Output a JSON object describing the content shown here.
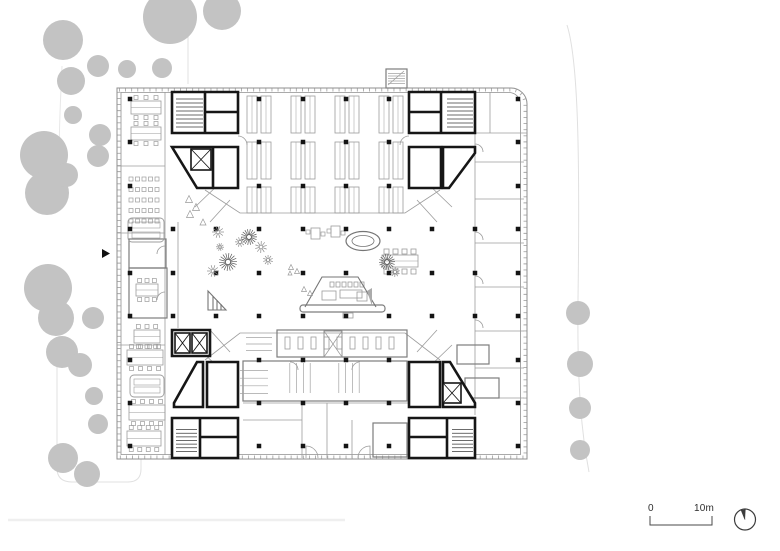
{
  "scale_bar": {
    "zero": "0",
    "ten": "10m"
  },
  "colors": {
    "tree": "#c3c3c3",
    "heavy": "#161616",
    "light": "#9c9c9c",
    "mid": "#757575",
    "facade": "#8f8f8f",
    "tick": "#a8a8a8",
    "column": "#141414",
    "site": "#e0e0e0",
    "stair": "#3a3a3a",
    "wedge": "#ababab",
    "marker": "#111111",
    "north": "#3c3c3c"
  },
  "geometry": {
    "site_paths": [
      {
        "d": "M567,25 C578,60 580,150 578,300 C577,390 582,435 589,472",
        "w": 1,
        "c": "#e0e0e0"
      },
      {
        "d": "M57,340 V468 Q57,482 72,482 H128 Q141,482 141,469 V450",
        "w": 1,
        "c": "#e0e0e0"
      },
      {
        "d": "M188,24 V84",
        "w": 1,
        "c": "#e0e0e0"
      },
      {
        "d": "M62,66 C60,110 58,150 60,195",
        "w": 1,
        "c": "#e8e8e8"
      },
      {
        "d": "M8,520 H345",
        "w": 2.5,
        "c": "#efefef"
      }
    ],
    "trees": [
      [
        63,
        40,
        20
      ],
      [
        170,
        17,
        27
      ],
      [
        222,
        11,
        19
      ],
      [
        98,
        66,
        11
      ],
      [
        127,
        69,
        9
      ],
      [
        162,
        68,
        10
      ],
      [
        71,
        81,
        14
      ],
      [
        73,
        115,
        9
      ],
      [
        44,
        155,
        24
      ],
      [
        47,
        193,
        22
      ],
      [
        66,
        175,
        12
      ],
      [
        100,
        135,
        11
      ],
      [
        98,
        156,
        11
      ],
      [
        48,
        288,
        24
      ],
      [
        56,
        318,
        18
      ],
      [
        93,
        318,
        11
      ],
      [
        62,
        352,
        16
      ],
      [
        80,
        365,
        12
      ],
      [
        94,
        396,
        9
      ],
      [
        98,
        424,
        10
      ],
      [
        63,
        458,
        15
      ],
      [
        87,
        474,
        13
      ],
      [
        578,
        313,
        12
      ],
      [
        580,
        364,
        13
      ],
      [
        580,
        408,
        11
      ],
      [
        580,
        450,
        10
      ]
    ],
    "building": {
      "outer": "M117,88 H511 A16,16 0 0 1 527,104 V459 H117 Z",
      "ticks": "M119,90 H510 A14,14 0 0 1 525,104 V457 H119 Z",
      "inner": "M121,92.5 H509 A11.5,11.5 0 0 1 520.5,104 V454.5 H121 Z"
    },
    "light_paths": [
      {
        "d": "M165,92 V455"
      },
      {
        "d": "M475,133 V415"
      },
      {
        "d": "M475,133 H527"
      },
      {
        "d": "M475,162 H524"
      },
      {
        "d": "M475,199 H524"
      },
      {
        "d": "M475,243 H524"
      },
      {
        "d": "M475,287 H524"
      },
      {
        "d": "M475,331 H524"
      },
      {
        "d": "M475,368 H524"
      },
      {
        "d": "M475,398 H524"
      },
      {
        "d": "M490,92 V133"
      },
      {
        "d": "M205,190 L240,213 H405 L440,190"
      },
      {
        "d": "M205,360 L240,333 H405 L440,360"
      },
      {
        "d": "M178,222 V328"
      },
      {
        "d": "M220,183 L195,207"
      },
      {
        "d": "M230,200 L210,222"
      },
      {
        "d": "M427,183 L452,207"
      },
      {
        "d": "M417,200 L437,222"
      },
      {
        "d": "M195,345 L220,369"
      },
      {
        "d": "M210,330 L230,352"
      },
      {
        "d": "M452,345 L427,369"
      },
      {
        "d": "M437,330 L417,352"
      },
      {
        "d": "M243,403 H408"
      },
      {
        "d": "M302,403 V458"
      },
      {
        "d": "M327,403 V458"
      },
      {
        "d": "M352,420 V458"
      },
      {
        "d": "M243,420 H302"
      },
      {
        "d": "M117,166 H165"
      },
      {
        "d": "M117,233 H165"
      },
      {
        "d": "M117,345 H165"
      },
      {
        "d": "M388,85 L404,71"
      }
    ],
    "mid_paths": [
      {
        "d": "M305,307 L322,277 H358 L376,307"
      },
      {
        "d": "M208,291 V310 H226 Z"
      },
      {
        "d": "M213,296 V310"
      },
      {
        "d": "M217,300 V310"
      },
      {
        "d": "M221,304 V310"
      }
    ],
    "rooms": [
      [
        129,
        239,
        37,
        29
      ],
      [
        129,
        268,
        38,
        50
      ],
      [
        457,
        345,
        32,
        19
      ],
      [
        465,
        378,
        34,
        20
      ],
      [
        373,
        423,
        34,
        34
      ],
      [
        386,
        69,
        21,
        19
      ],
      [
        277,
        330,
        130,
        27
      ],
      [
        243,
        361,
        164,
        40
      ],
      [
        300,
        305,
        85,
        7
      ]
    ],
    "rects_light": [
      [
        322,
        291,
        14,
        9
      ],
      [
        340,
        290,
        22,
        8
      ],
      [
        357,
        292,
        10,
        9
      ],
      [
        343,
        313,
        10,
        5
      ],
      [
        311,
        228,
        9,
        11
      ],
      [
        331,
        226,
        9,
        11
      ]
    ],
    "row_rects": [
      {
        "x0": 285,
        "y": 337,
        "w": 5,
        "h": 12,
        "dx": 13,
        "n": 9
      },
      {
        "x0": 330,
        "y": 282,
        "w": 4,
        "h": 5,
        "dx": 6,
        "n": 6
      },
      {
        "x0": 384,
        "y": 249,
        "w": 5,
        "h": 5,
        "dx": 9,
        "n": 4
      },
      {
        "x0": 384,
        "y": 269,
        "w": 5,
        "h": 5,
        "dx": 9,
        "n": 4
      }
    ],
    "desks": [
      {
        "x": 131,
        "y": 101,
        "w": 30,
        "h": 13,
        "n": 3
      },
      {
        "x": 131,
        "y": 127,
        "w": 30,
        "h": 13,
        "n": 3
      },
      {
        "x": 127,
        "y": 350,
        "w": 36,
        "h": 15,
        "n": 4
      },
      {
        "x": 129,
        "y": 405,
        "w": 36,
        "h": 15,
        "n": 4
      },
      {
        "x": 127,
        "y": 431,
        "w": 34,
        "h": 15,
        "n": 4
      },
      {
        "x": 136,
        "y": 284,
        "w": 22,
        "h": 12,
        "n": 3
      },
      {
        "x": 134,
        "y": 330,
        "w": 26,
        "h": 13,
        "n": 3
      },
      {
        "x": 382,
        "y": 255,
        "w": 36,
        "h": 12,
        "n": 0
      }
    ],
    "sofas": [
      [
        128,
        218,
        36,
        24
      ],
      [
        130,
        375,
        34,
        22
      ]
    ],
    "lockers": {
      "x0": 129,
      "y0": 177,
      "cols": 5,
      "rows": 5,
      "s": 4,
      "dx": 6.5,
      "dy": 10.5
    },
    "benches": {
      "rows": [
        {
          "y": 96,
          "h": 37
        },
        {
          "y": 142,
          "h": 37
        },
        {
          "y": 187,
          "h": 26
        }
      ],
      "xs": [
        247,
        291,
        335,
        379
      ],
      "bw": 10,
      "gap": 4
    },
    "hatch_light": [
      {
        "x": 283,
        "y": 363,
        "w": 34,
        "h": 30,
        "n": 4,
        "dir": "v"
      },
      {
        "x": 332,
        "y": 363,
        "w": 34,
        "h": 30,
        "n": 4,
        "dir": "v"
      },
      {
        "x": 240,
        "y": 363,
        "w": 28,
        "h": 38,
        "n": 4,
        "dir": "h"
      },
      {
        "x": 246,
        "y": 331,
        "w": 26,
        "h": 26,
        "n": 3,
        "dir": "h"
      },
      {
        "x": 388,
        "y": 71,
        "w": 17,
        "h": 15,
        "n": 5,
        "dir": "h"
      }
    ],
    "hatch_dark": [
      {
        "x": 176,
        "y": 95,
        "w": 27,
        "h": 36,
        "n": 8,
        "dir": "h"
      },
      {
        "x": 447,
        "y": 95,
        "w": 26,
        "h": 36,
        "n": 8,
        "dir": "h"
      },
      {
        "x": 176,
        "y": 426,
        "w": 21,
        "h": 29,
        "n": 7,
        "dir": "h"
      },
      {
        "x": 452,
        "y": 426,
        "w": 21,
        "h": 29,
        "n": 7,
        "dir": "h"
      }
    ],
    "heavy": [
      {
        "d": "M172,92 H238 V133 H172 Z",
        "f": 1
      },
      {
        "d": "M205,92 V133"
      },
      {
        "d": "M205,112 H238"
      },
      {
        "d": "M172,147 H238 V188 H197 Z",
        "f": 1
      },
      {
        "d": "M213,147 V188"
      },
      {
        "d": "M409,92 H475 V133 H409 Z",
        "f": 1
      },
      {
        "d": "M441,92 V133"
      },
      {
        "d": "M409,112 H441"
      },
      {
        "d": "M409,147 H441 V188 H409 Z",
        "f": 1
      },
      {
        "d": "M443,147 H475 V153 L449,188 H443 Z",
        "f": 1
      },
      {
        "d": "M172,330 H210 V356 H172 Z",
        "f": 1
      },
      {
        "d": "M197,362 H203 V407 H174 V403 Z",
        "f": 1
      },
      {
        "d": "M207,362 H238 V407 H207 Z",
        "f": 1
      },
      {
        "d": "M172,418 H238 V458 H172 Z",
        "f": 1
      },
      {
        "d": "M200,418 V458"
      },
      {
        "d": "M200,437 H238"
      },
      {
        "d": "M409,362 H440 V407 H409 Z",
        "f": 1
      },
      {
        "d": "M443,362 H450 L475,403 V407 H443 Z",
        "f": 1
      },
      {
        "d": "M409,418 H475 V458 H409 Z",
        "f": 1
      },
      {
        "d": "M447,418 V458"
      },
      {
        "d": "M409,437 H447"
      }
    ],
    "xboxes": [
      [
        191,
        149,
        20,
        21
      ],
      [
        175,
        333,
        15,
        20
      ],
      [
        192,
        333,
        15,
        20
      ],
      [
        443,
        383,
        18,
        20
      ]
    ],
    "xboxes_gray": [
      [
        324,
        331,
        18,
        26
      ]
    ],
    "columns": {
      "xs": [
        130,
        173,
        216,
        259,
        303,
        346,
        389,
        432,
        475,
        518
      ],
      "ys": [
        99,
        142,
        186,
        229,
        273,
        316,
        360,
        403,
        446
      ],
      "s": 4.5,
      "exclude": [
        [
          166,
          86,
          76,
          110
        ],
        [
          403,
          86,
          76,
          110
        ],
        [
          166,
          325,
          76,
          140
        ],
        [
          403,
          355,
          76,
          110
        ]
      ]
    },
    "arcs": [
      "M306,458 v-12 a12,12 0 0 1 12,12",
      "M370,458 v-12 a12,12 0 0 0 -12,12",
      "M238,136 a9,9 0 0 1 9,9",
      "M409,136 a9,9 0 0 0 -9,9",
      "M475,144 a8,8 0 0 1 8,8",
      "M475,232 a8,8 0 0 1 8,8",
      "M475,276 a8,8 0 0 1 8,8",
      "M475,320 a8,8 0 0 1 8,8",
      "M165,246 a8,8 0 0 0 -8,8",
      "M165,292 a8,8 0 0 0 -8,8",
      "M290,362 a8,8 0 0 1 8,8",
      "M360,362 a8,8 0 0 0 -8,8"
    ],
    "ellipses": [
      {
        "cx": 363,
        "cy": 241,
        "rx": 17,
        "ry": 9.5,
        "w": 1.2
      },
      {
        "cx": 363,
        "cy": 241,
        "rx": 11,
        "ry": 5.5,
        "w": 0.8
      }
    ],
    "plants": [
      {
        "x": 218,
        "y": 232,
        "r": 6
      },
      {
        "x": 249,
        "y": 237,
        "r": 8,
        "k": 1
      },
      {
        "x": 240,
        "y": 242,
        "r": 5
      },
      {
        "x": 261,
        "y": 247,
        "r": 6
      },
      {
        "x": 228,
        "y": 262,
        "r": 9,
        "k": 1
      },
      {
        "x": 213,
        "y": 271,
        "r": 6
      },
      {
        "x": 268,
        "y": 260,
        "r": 5
      },
      {
        "x": 387,
        "y": 262,
        "r": 8,
        "k": 1
      },
      {
        "x": 395,
        "y": 272,
        "r": 5
      },
      {
        "x": 220,
        "y": 247,
        "r": 4
      }
    ],
    "tri_plants": [
      [
        189,
        199,
        7
      ],
      [
        196,
        207,
        7
      ],
      [
        190,
        214,
        7
      ],
      [
        203,
        222,
        6
      ],
      [
        291,
        267,
        5
      ],
      [
        297,
        271,
        5
      ],
      [
        290,
        273,
        4
      ],
      [
        304,
        289,
        5
      ],
      [
        310,
        293,
        5
      ]
    ],
    "squares": [
      [
        306,
        230,
        4
      ],
      [
        321,
        232,
        4
      ],
      [
        327,
        229,
        4
      ],
      [
        341,
        231,
        4
      ]
    ],
    "polys": [
      {
        "pts": "102,249 110,253.5 102,258",
        "f": "#111111"
      },
      {
        "pts": "367,291 372,288 372,306",
        "f": "#ababab"
      }
    ]
  }
}
